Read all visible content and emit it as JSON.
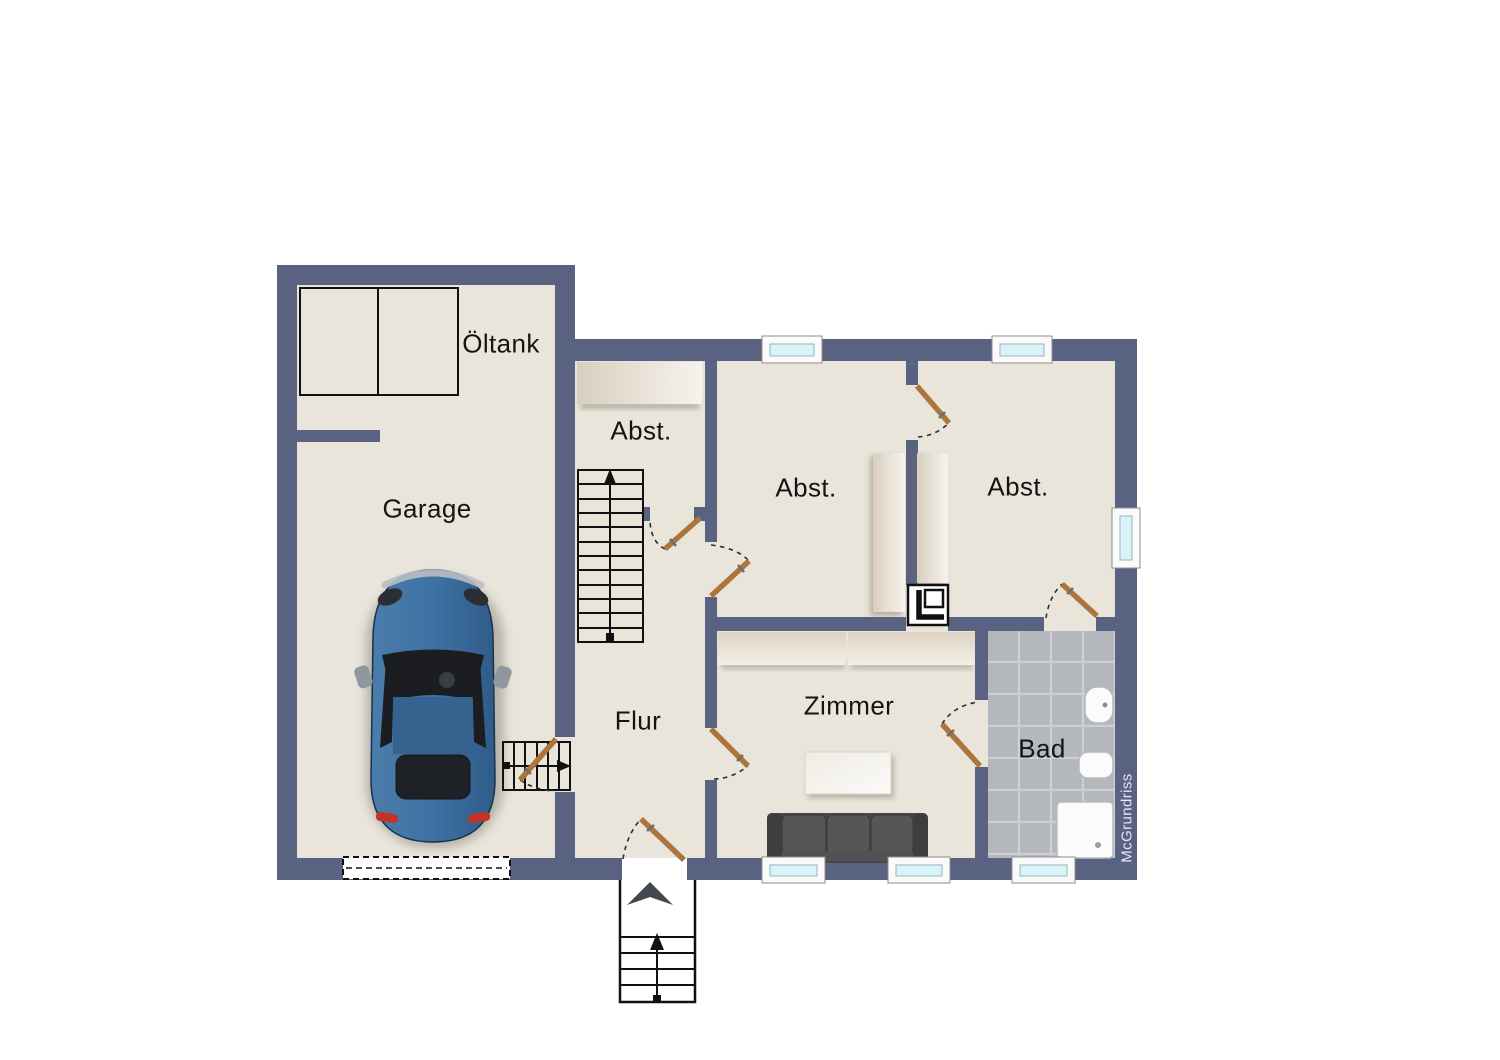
{
  "watermark": "McGrundriss",
  "rooms": {
    "garage": "Garage",
    "oeltank": "Öltank",
    "abst_left": "Abst.",
    "abst_middle": "Abst.",
    "abst_right": "Abst.",
    "flur": "Flur",
    "zimmer": "Zimmer",
    "bad": "Bad"
  },
  "colors": {
    "wall": "#5a6282",
    "floor": "#e9e5da",
    "tile": "#b4b8bd",
    "tile_grout": "#ccd0d4",
    "window_glass": "#d8f4f8",
    "window_frame": "#fafafa",
    "door_leaf": "#ad753e",
    "furniture_light": "#f6f3ed",
    "furniture_dark": "#d9cfc0",
    "sofa": "#48484b",
    "car_body": "#3e72a3",
    "line": "#111111",
    "background": "#ffffff",
    "watermark_color": "#e3e6f0"
  }
}
